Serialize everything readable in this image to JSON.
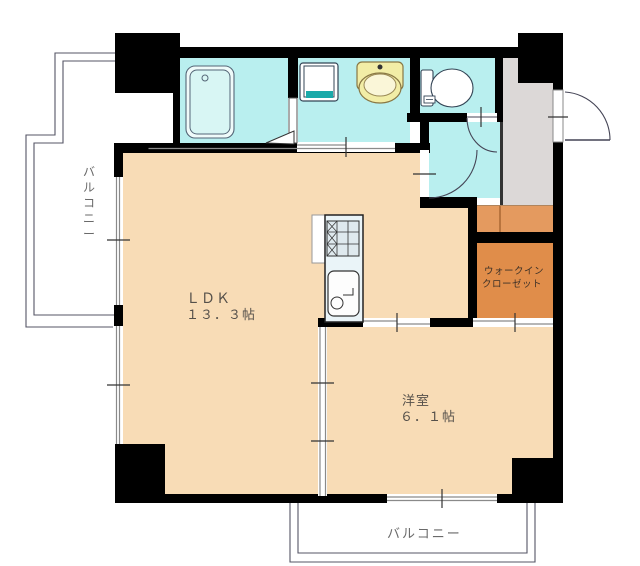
{
  "plan": {
    "labels": {
      "ldk_name": "ＬＤＫ",
      "ldk_size": "１３．３帖",
      "bedroom_name": "洋室",
      "bedroom_size": "６．１帖",
      "wic_line1": "ウォークイン",
      "wic_line2": "クローゼット",
      "balcony_left": "バルコニー",
      "balcony_bottom": "バルコニー"
    },
    "colors": {
      "wall": "#000000",
      "floor": "#f8dcb6",
      "wet_area": "#b9efef",
      "tub_inner": "#d8f6f4",
      "tub_outer": "#effbfa",
      "entry_gray": "#dcd8d7",
      "step_orange": "#e49a5f",
      "wic_orange": "#e08d4a",
      "basin_yellow": "#f2eda6",
      "basin_inner": "#faf6d8",
      "pan_teal": "#1aa9a9",
      "kitchen_unit": "#eaf4f8",
      "stove_fill": "#dfe9ee",
      "fixture_white": "#ffffff",
      "outline": "#444444",
      "track_gray": "#8a8a8a",
      "text_dark": "#55504a",
      "text_gray": "#6a6a6a"
    }
  }
}
